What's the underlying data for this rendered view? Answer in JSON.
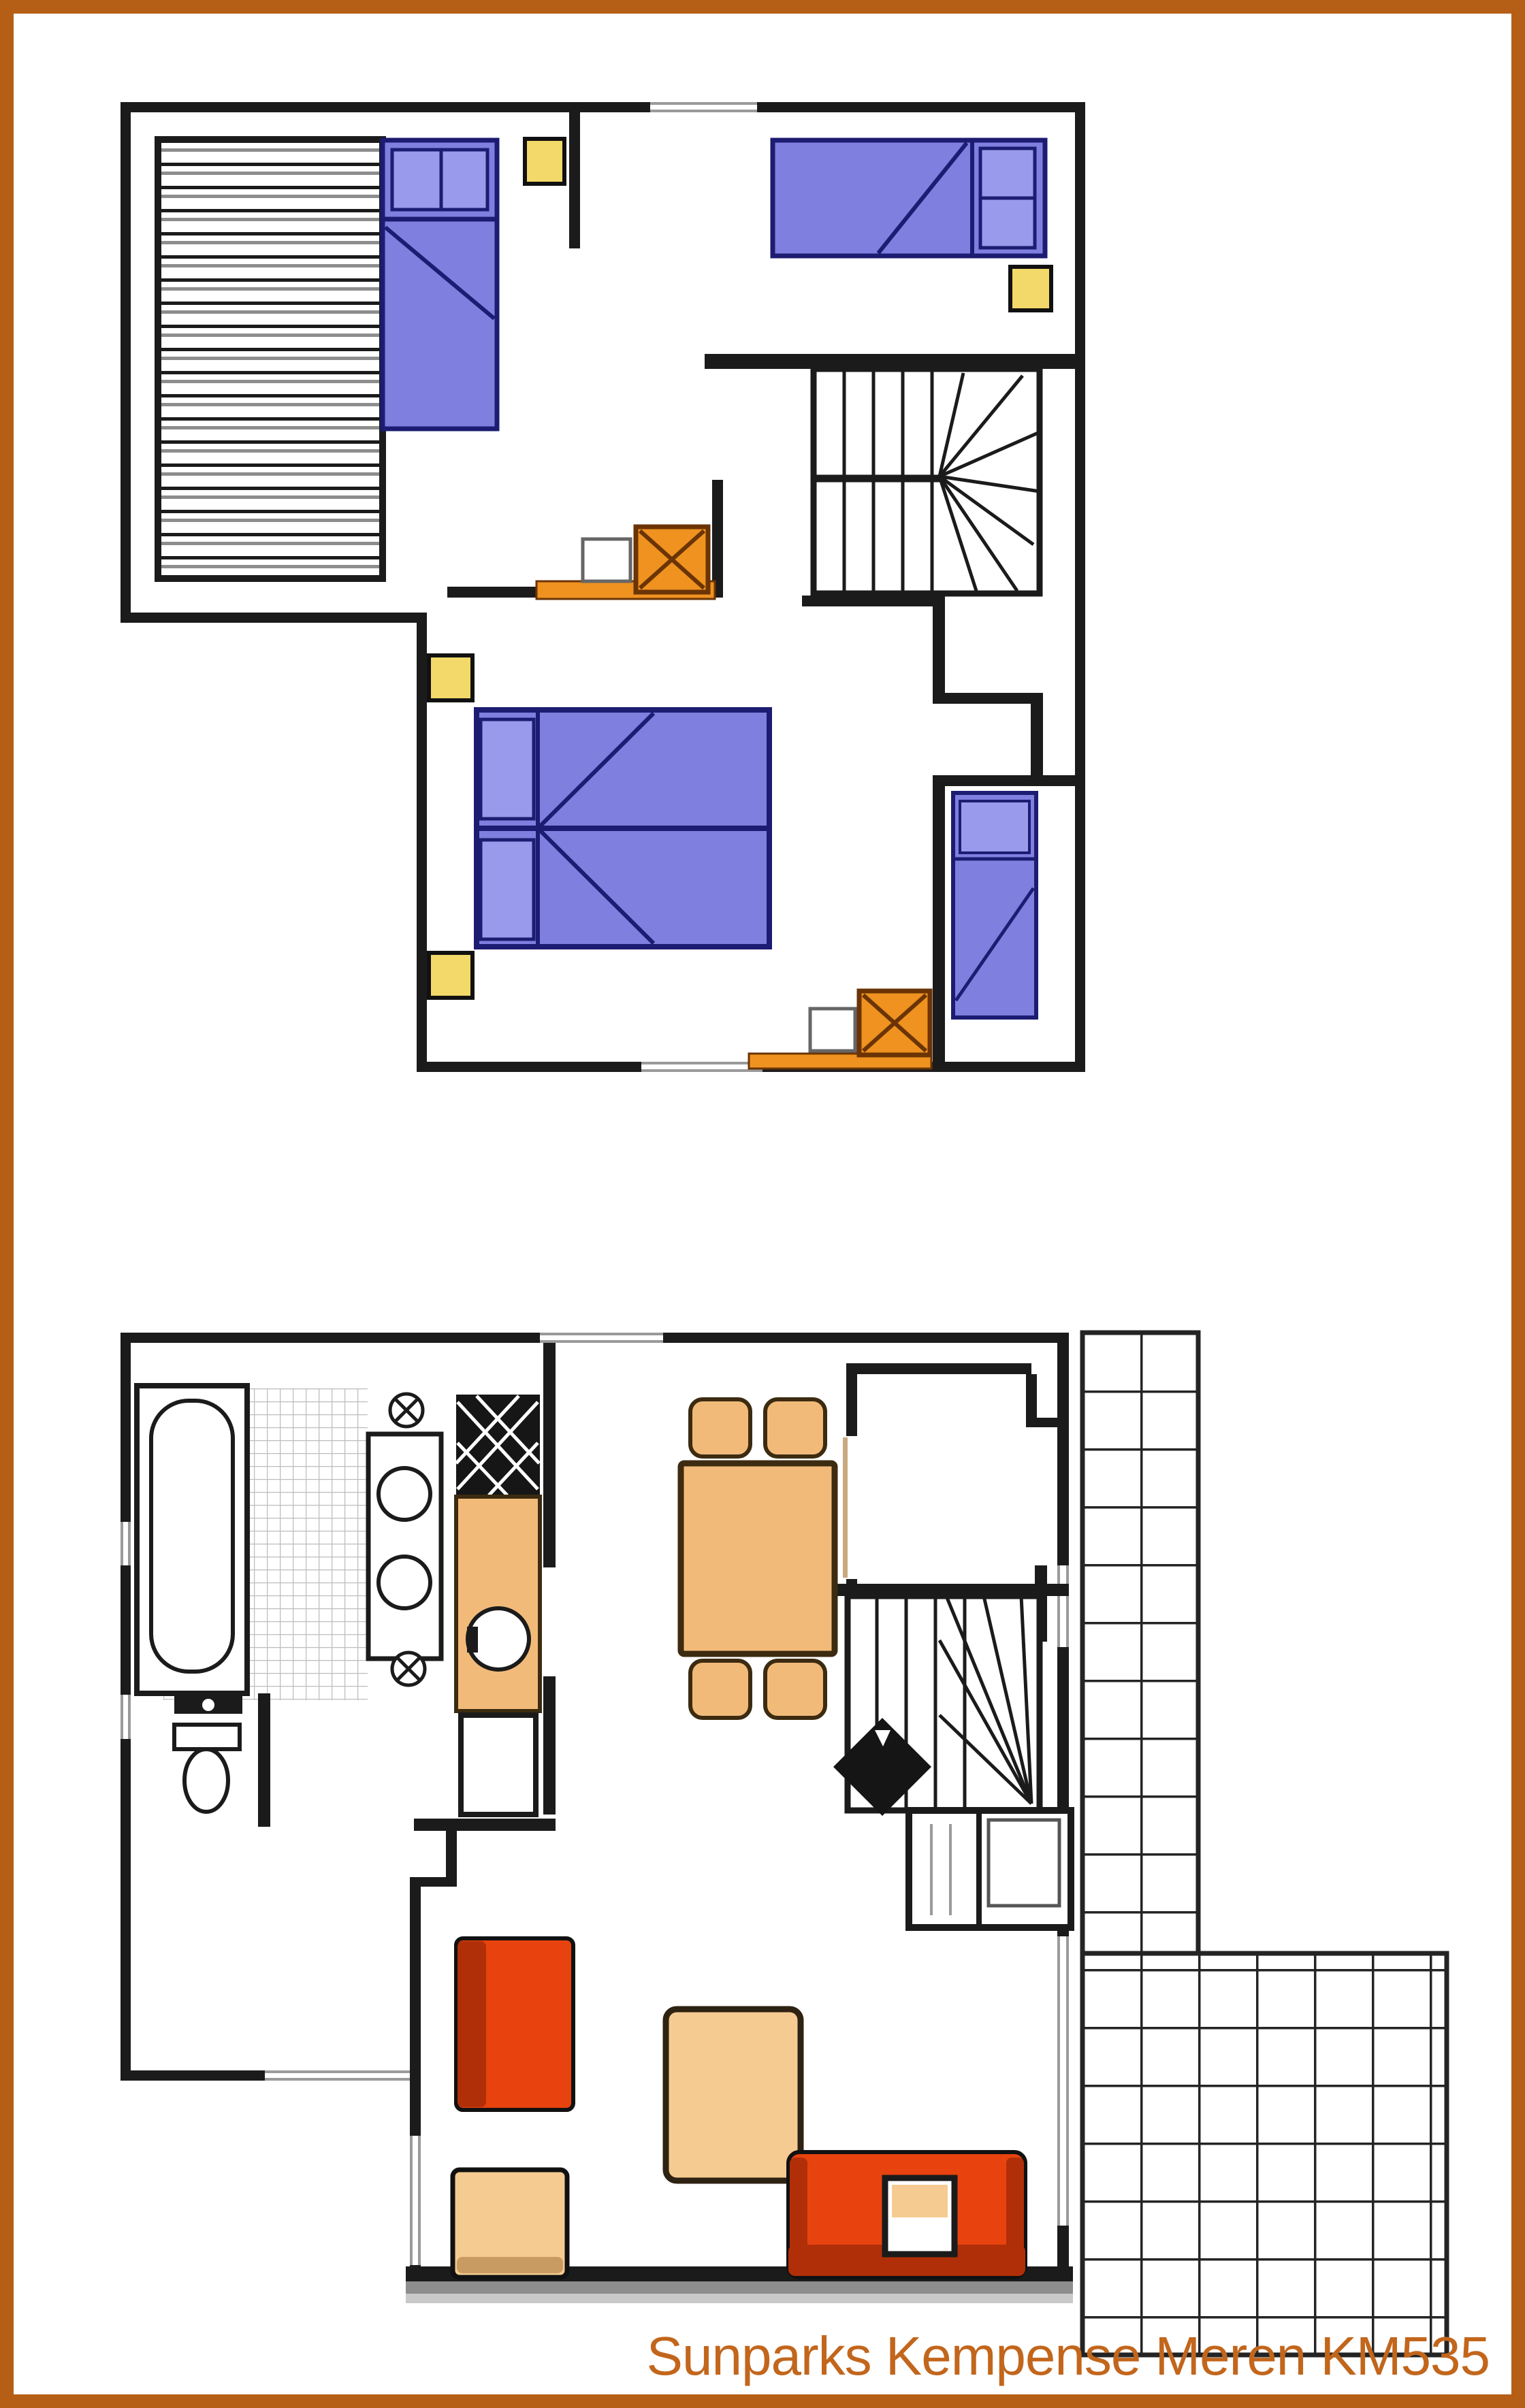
{
  "caption": {
    "text": "Sunparks Kempense Meren KM535"
  },
  "colors": {
    "frame": "#b55e16",
    "caption": "#c2661c",
    "wall": "#1b1b1b",
    "bed": "#7f7fe0",
    "bed_border": "#1c1c72",
    "pillow": "#9a9aec",
    "nightstand": "#f2d969",
    "basin": "#ef9220",
    "basin_border": "#6b3405",
    "counter_orange": "#f2ba79",
    "furniture_tan": "#f6cb92",
    "wood_dark": "#3c2b10",
    "sofa_red": "#e8430f",
    "sofa_red_dark": "#b02f08",
    "window_line": "#9a9a9a",
    "tile_line": "#bdbdbd",
    "terrace_line": "#242424",
    "door_tan": "#c9a97e",
    "shadow1": "#8d8d8d",
    "shadow2": "#c9c9c9"
  },
  "floors": [
    {
      "name": "upper-floor",
      "items": [
        "attic-storage-hatch",
        "single-bed",
        "single-bed",
        "double-bed",
        "alcove-single-bed",
        "nightstand",
        "nightstand",
        "nightstand",
        "nightstand",
        "washbasin",
        "washbasin",
        "winder-staircase",
        "window",
        "window"
      ]
    },
    {
      "name": "ground-floor",
      "items": [
        "bathtub",
        "toilet",
        "floor-tiles",
        "cooker-burners",
        "hob",
        "kitchen-sink",
        "kitchen-cupboard",
        "dining-table",
        "dining-chair",
        "dining-chair",
        "dining-chair",
        "dining-chair",
        "entrance-hall",
        "winder-staircase",
        "stove-diamond",
        "storage-cabinet",
        "sofa",
        "sofa",
        "armchair",
        "coffee-table",
        "tv-unit",
        "terrace-tiles",
        "front-door",
        "terrace-door"
      ]
    }
  ]
}
